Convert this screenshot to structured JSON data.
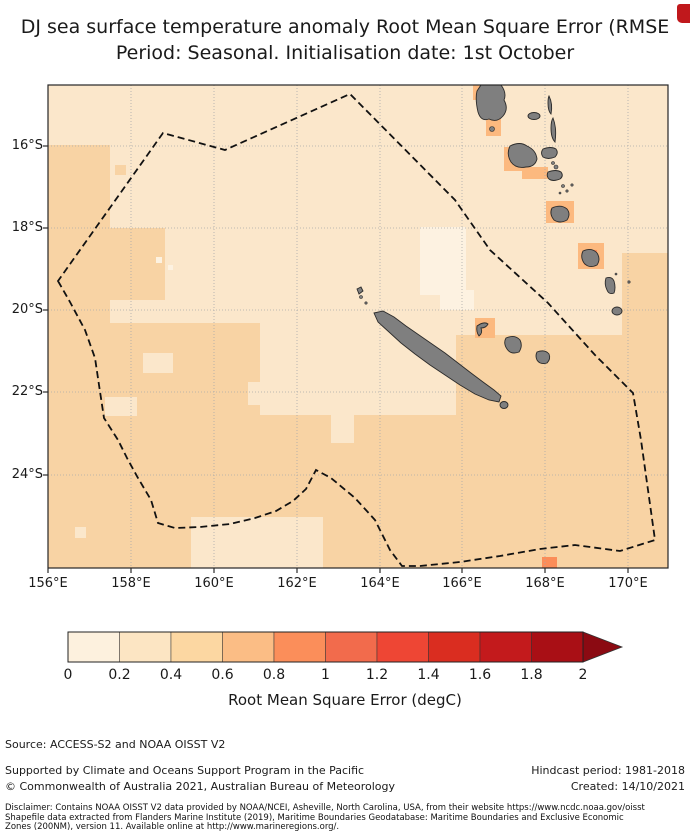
{
  "title": {
    "line1": "DJ sea surface temperature anomaly Root Mean Square Error (RMSE",
    "line2": "Period: Seasonal. Initialisation date: 1st October"
  },
  "decor": {
    "clipped_red_mark_color": "#c0181c"
  },
  "footer": {
    "source": "Source: ACCESS-S2 and NOAA OISST V2",
    "supported": "Supported by Climate and Oceans Support Program in the Pacific",
    "hindcast": "Hindcast period: 1981-2018",
    "copyright": "© Commonwealth of Australia 2021, Australian Bureau of Meteorology",
    "created": "Created: 14/10/2021",
    "disclaimer1": "Disclaimer: Contains NOAA OISST V2 data provided by NOAA/NCEI, Asheville, North Carolina, USA, from their website https://www.ncdc.noaa.gov/oisst",
    "disclaimer2": "Shapefile data extracted from Flanders Marine Institute (2019), Maritime Boundaries Geodatabase: Maritime Boundaries and Exclusive Economic",
    "disclaimer3": "Zones (200NM), version 11. Available online at http://www.marineregions.org/."
  },
  "chart_data": {
    "type": "heatmap",
    "subtype": "geographic-map",
    "title": "DJ sea surface temperature anomaly Root Mean Square Error (RMSE) — Period: Seasonal. Initialisation date: 1st October",
    "region": "New Caledonia / Vanuatu EEZ, southwest Pacific",
    "x_axis": {
      "ticks": [
        "156°E",
        "158°E",
        "160°E",
        "162°E",
        "164°E",
        "166°E",
        "168°E",
        "170°E"
      ],
      "lon_range": [
        156,
        171
      ]
    },
    "y_axis": {
      "ticks": [
        "16°S",
        "18°S",
        "20°S",
        "22°S",
        "24°S"
      ],
      "lat_range": [
        -26.3,
        -14.5
      ]
    },
    "grid": true,
    "colorbar": {
      "label": "Root Mean Square Error (degC)",
      "ticks": [
        "0",
        "0.2",
        "0.4",
        "0.6",
        "0.8",
        "1",
        "1.2",
        "1.4",
        "1.6",
        "1.8",
        "2"
      ],
      "range": [
        0,
        2
      ],
      "bin_width": 0.2,
      "extend": "max-arrow",
      "segment_colors": [
        "#fdf1de",
        "#fce5c3",
        "#fcd7a2",
        "#fbbd85",
        "#fb8e5a",
        "#f26b4c",
        "#ee4634",
        "#da2d20",
        "#c31a1c",
        "#a90f15"
      ],
      "arrow_color": "#8b0a12"
    },
    "value_bins_shown_on_map": {
      "0-0.2": "#fdf2e1",
      "0.2-0.4": "#fbe7cb",
      "0.4-0.6": "#f8d3a4",
      "0.6-0.8": "#fcb97f",
      "0.8-1.0": "#fb8d59"
    },
    "map_summary": "RMSE mostly 0.2-0.4 degC over open ocean inside the dashed EEZ polygon; 0.4-0.6 degC along the west, south and southeast; isolated 0.6-1.0 degC cells hugging the Vanuatu islands (Santo, Malakula, Efate, Erromango) and one cell near 166.5E,26S; lowest values (0-0.2) in small patches near 165-166E,18-20S.",
    "geometry": {
      "map_px": {
        "w": 620,
        "h": 483
      },
      "colors": {
        "bin0": "#fdf2e1",
        "base": "#fbe7cb",
        "bin2": "#f8d3a4",
        "bin3": "#fcb97f",
        "bin4": "#fb8d59",
        "island_fill": "#7f7f7f",
        "island_stroke": "#2b2b2b",
        "grid": "#aaaaaa",
        "eez": "#111111",
        "frame": "#262626"
      },
      "x_tick_px": [
        0,
        83,
        166,
        249,
        332,
        414,
        497,
        580
      ],
      "y_tick_px": [
        61,
        143,
        225,
        307,
        390
      ],
      "patches_bin2": [
        [
          0,
          60,
          62,
          195
        ],
        [
          62,
          143,
          55,
          72
        ],
        [
          0,
          238,
          212,
          245
        ],
        [
          170,
          330,
          252,
          153
        ],
        [
          408,
          250,
          212,
          233
        ],
        [
          574,
          168,
          46,
          92
        ],
        [
          67,
          80,
          11,
          10
        ]
      ],
      "patches_base_holes": [
        [
          143,
          432,
          132,
          51
        ],
        [
          200,
          297,
          62,
          23
        ],
        [
          57,
          312,
          32,
          19
        ],
        [
          283,
          326,
          23,
          32
        ],
        [
          27,
          442,
          11,
          11
        ],
        [
          95,
          268,
          30,
          20
        ]
      ],
      "patches_bin0": [
        [
          372,
          142,
          46,
          68
        ],
        [
          392,
          205,
          34,
          20
        ],
        [
          108,
          172,
          6,
          6
        ],
        [
          120,
          180,
          5,
          5
        ]
      ],
      "patches_bin3": [
        [
          425,
          0,
          20,
          15
        ],
        [
          438,
          34,
          15,
          17
        ],
        [
          456,
          62,
          24,
          24
        ],
        [
          474,
          82,
          26,
          12
        ],
        [
          498,
          116,
          28,
          22
        ],
        [
          427,
          233,
          20,
          20
        ],
        [
          530,
          158,
          26,
          26
        ]
      ],
      "patches_bin4": [
        [
          536,
          165,
          13,
          15
        ],
        [
          494,
          472,
          15,
          11
        ]
      ],
      "eez_points": "10,196 22,217 37,245 47,273 51,300 56,333 70,355 79,373 90,393 103,415 110,438 127,443 152,442 182,439 207,433 228,426 245,416 258,404 268,385 283,393 307,413 327,435 342,465 354,481 372,481 412,477 452,471 492,464 527,460 572,466 607,455 600,405 593,355 585,308 547,270 500,218 442,165 407,115 302,9 177,65 115,48",
      "island_paths": [
        {
          "name": "grande-terre",
          "d": "M326,228 L335,226 L346,232 L358,241 L371,250 L384,259 L397,268 L410,278 L423,288 L435,297 L446,305 L453,311 L451,317 L441,315 L427,309 L412,300 L397,290 L382,280 L367,269 L353,258 L341,247 L330,237 Z"
        },
        {
          "name": "espiritu-santo",
          "d": "M433,0 L453,0 Q459,8 456,15 Q461,24 455,31 Q449,38 441,34 Q433,37 430,27 Q427,14 429,6 Z"
        },
        {
          "name": "malakula",
          "d": "M462,61 Q472,56 479,61 Q488,65 489,74 Q487,82 478,82 Q468,84 463,77 Q458,69 462,61 Z"
        },
        {
          "name": "pentecost",
          "d": "M505,33 Q509,43 507,57 Q503,53 503,43 Q503,36 505,33 Z"
        },
        {
          "name": "maewo",
          "d": "M501,11 Q505,19 503,29 Q500,26 500,18 Q500,13 501,11 Z"
        },
        {
          "name": "ambrym",
          "d": "M495,64 Q503,61 508,64 Q511,68 507,72 Q500,75 495,72 Q492,68 495,64 Z"
        },
        {
          "name": "epi",
          "d": "M500,87 Q508,84 513,87 Q516,91 512,94 Q505,97 501,94 Q498,91 500,87 Z"
        },
        {
          "name": "efate",
          "d": "M504,123 Q513,119 519,124 Q523,129 519,135 Q512,139 506,135 Q501,129 504,123 Z"
        },
        {
          "name": "erromango",
          "d": "M535,166 Q544,162 549,168 Q553,174 549,180 Q541,184 536,178 Q532,172 535,166 Z"
        },
        {
          "name": "tanna",
          "d": "M558,193 Q564,191 566,196 Q568,203 566,208 Q561,210 559,205 Q556,199 558,193 Z"
        },
        {
          "name": "lifou",
          "d": "M458,253 Q467,249 472,255 Q475,261 471,267 Q463,270 459,264 Q455,258 458,253 Z"
        },
        {
          "name": "mare",
          "d": "M489,267 Q497,264 501,269 Q503,274 499,278 Q492,280 489,275 Q487,271 489,267 Z"
        },
        {
          "name": "ouvea",
          "d": "M429,241 Q436,236 440,239 Q438,243 433,243 Q435,248 431,251 Q428,247 429,241 Z"
        },
        {
          "name": "belep",
          "d": "M309,204 L313,202 L315,206 L311,209 Z"
        }
      ],
      "island_ellipses": [
        {
          "name": "aoba",
          "cx": 486,
          "cy": 31,
          "rx": 6,
          "ry": 3.5
        },
        {
          "name": "aneityum",
          "cx": 569,
          "cy": 226,
          "rx": 5,
          "ry": 4
        },
        {
          "name": "isle-of-pines",
          "cx": 456,
          "cy": 320,
          "rx": 4,
          "ry": 3.5
        }
      ],
      "island_dots": [
        [
          313,
          212,
          1.5
        ],
        [
          318,
          218,
          1.2
        ],
        [
          444,
          44,
          2.5
        ],
        [
          505,
          78,
          1.5
        ],
        [
          508,
          82,
          2
        ],
        [
          515,
          101,
          1.5
        ],
        [
          519,
          106,
          1.2
        ],
        [
          512,
          108,
          1
        ],
        [
          524,
          100,
          1.2
        ],
        [
          568,
          189,
          1
        ],
        [
          581,
          197,
          1.2
        ]
      ]
    }
  }
}
